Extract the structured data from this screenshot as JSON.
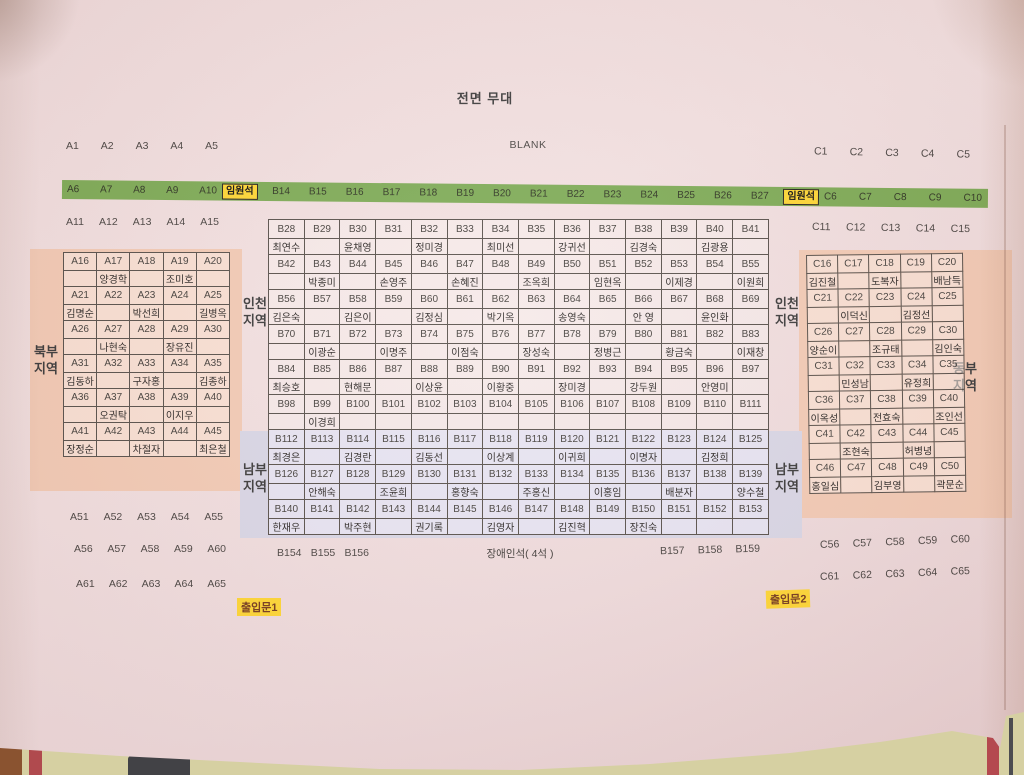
{
  "stage": {
    "title": "전면 무대",
    "blank": "BLANK"
  },
  "vip": "임원석",
  "doors": {
    "door1": "출입문1",
    "door2": "출입문2"
  },
  "disabled_seats": "장애인석( 4석 )",
  "regions": {
    "north": "북부지역",
    "incheon_left": "인천지역",
    "incheon_right": "인천지역",
    "south_left": "남부지역",
    "south_right": "남부지역",
    "east": "동부지역"
  },
  "green_row": {
    "left": [
      "A6",
      "A7",
      "A8",
      "A9",
      "A10"
    ],
    "center": [
      "B14",
      "B15",
      "B16",
      "B17",
      "B18",
      "B19",
      "B20",
      "B21",
      "B22",
      "B23",
      "B24",
      "B25",
      "B26",
      "B27"
    ],
    "right": [
      "C6",
      "C7",
      "C8",
      "C9",
      "C10"
    ]
  },
  "rows": {
    "a1": [
      "A1",
      "A2",
      "A3",
      "A4",
      "A5"
    ],
    "a11": [
      "A11",
      "A12",
      "A13",
      "A14",
      "A15"
    ],
    "a46": [
      "A46",
      "A47",
      "A48",
      "A49",
      "A50"
    ],
    "a51": [
      "A51",
      "A52",
      "A53",
      "A54",
      "A55"
    ],
    "a56": [
      "A56",
      "A57",
      "A58",
      "A59",
      "A60"
    ],
    "a61": [
      "A61",
      "A62",
      "A63",
      "A64",
      "A65"
    ],
    "c1": [
      "C1",
      "C2",
      "C3",
      "C4",
      "C5"
    ],
    "c11": [
      "C11",
      "C12",
      "C13",
      "C14",
      "C15"
    ],
    "c51": [
      "C51",
      "C52",
      "C53",
      "C54",
      "C55"
    ],
    "c56": [
      "C56",
      "C57",
      "C58",
      "C59",
      "C60"
    ],
    "c61": [
      "C61",
      "C62",
      "C63",
      "C64",
      "C65"
    ],
    "b154": [
      "B154",
      "B155",
      "B156"
    ],
    "b157": [
      "B157",
      "B158",
      "B159"
    ]
  },
  "tables": {
    "a": [
      {
        "seats": [
          "A16",
          "A17",
          "A18",
          "A19",
          "A20"
        ],
        "names": [
          "",
          "양경학",
          "",
          "조미호",
          ""
        ]
      },
      {
        "seats": [
          "A21",
          "A22",
          "A23",
          "A24",
          "A25"
        ],
        "names": [
          "김명순",
          "",
          "박선희",
          "",
          "길병옥"
        ]
      },
      {
        "seats": [
          "A26",
          "A27",
          "A28",
          "A29",
          "A30"
        ],
        "names": [
          "",
          "나현숙",
          "",
          "장유진",
          ""
        ]
      },
      {
        "seats": [
          "A31",
          "A32",
          "A33",
          "A34",
          "A35"
        ],
        "names": [
          "김동하",
          "",
          "구자홍",
          "",
          "김종하"
        ]
      },
      {
        "seats": [
          "A36",
          "A37",
          "A38",
          "A39",
          "A40"
        ],
        "names": [
          "",
          "오권탁",
          "",
          "이지우",
          ""
        ]
      },
      {
        "seats": [
          "A41",
          "A42",
          "A43",
          "A44",
          "A45"
        ],
        "names": [
          "장정순",
          "",
          "차절자",
          "",
          "최은철"
        ]
      }
    ],
    "b": [
      {
        "seats": [
          "B28",
          "B29",
          "B30",
          "B31",
          "B32",
          "B33",
          "B34",
          "B35",
          "B36",
          "B37",
          "B38",
          "B39",
          "B40",
          "B41"
        ],
        "names": [
          "최연수",
          "",
          "윤채영",
          "",
          "정미경",
          "",
          "최미선",
          "",
          "강귀선",
          "",
          "김경숙",
          "",
          "김광용",
          ""
        ]
      },
      {
        "seats": [
          "B42",
          "B43",
          "B44",
          "B45",
          "B46",
          "B47",
          "B48",
          "B49",
          "B50",
          "B51",
          "B52",
          "B53",
          "B54",
          "B55"
        ],
        "names": [
          "",
          "박종미",
          "",
          "손영주",
          "",
          "손혜진",
          "",
          "조옥희",
          "",
          "임현옥",
          "",
          "이제경",
          "",
          "이원희"
        ]
      },
      {
        "seats": [
          "B56",
          "B57",
          "B58",
          "B59",
          "B60",
          "B61",
          "B62",
          "B63",
          "B64",
          "B65",
          "B66",
          "B67",
          "B68",
          "B69"
        ],
        "names": [
          "김은숙",
          "",
          "김은이",
          "",
          "김정심",
          "",
          "박기옥",
          "",
          "송영숙",
          "",
          "안 영",
          "",
          "윤인화",
          ""
        ]
      },
      {
        "seats": [
          "B70",
          "B71",
          "B72",
          "B73",
          "B74",
          "B75",
          "B76",
          "B77",
          "B78",
          "B79",
          "B80",
          "B81",
          "B82",
          "B83"
        ],
        "names": [
          "",
          "이광순",
          "",
          "이명주",
          "",
          "이점숙",
          "",
          "장성숙",
          "",
          "정병근",
          "",
          "황금숙",
          "",
          "이재창"
        ]
      },
      {
        "seats": [
          "B84",
          "B85",
          "B86",
          "B87",
          "B88",
          "B89",
          "B90",
          "B91",
          "B92",
          "B93",
          "B94",
          "B95",
          "B96",
          "B97"
        ],
        "names": [
          "최승호",
          "",
          "현해문",
          "",
          "이상윤",
          "",
          "이황중",
          "",
          "장미경",
          "",
          "강두원",
          "",
          "안영미",
          ""
        ]
      },
      {
        "seats": [
          "B98",
          "B99",
          "B100",
          "B101",
          "B102",
          "B103",
          "B104",
          "B105",
          "B106",
          "B107",
          "B108",
          "B109",
          "B110",
          "B111"
        ],
        "names": [
          "",
          "이경희",
          "",
          "",
          "",
          "",
          "",
          "",
          "",
          "",
          "",
          "",
          "",
          ""
        ]
      },
      {
        "seats": [
          "B112",
          "B113",
          "B114",
          "B115",
          "B116",
          "B117",
          "B118",
          "B119",
          "B120",
          "B121",
          "B122",
          "B123",
          "B124",
          "B125"
        ],
        "names": [
          "최경은",
          "",
          "김경란",
          "",
          "김동선",
          "",
          "이상계",
          "",
          "이귀희",
          "",
          "이명자",
          "",
          "김정희",
          ""
        ]
      },
      {
        "seats": [
          "B126",
          "B127",
          "B128",
          "B129",
          "B130",
          "B131",
          "B132",
          "B133",
          "B134",
          "B135",
          "B136",
          "B137",
          "B138",
          "B139"
        ],
        "names": [
          "",
          "안해숙",
          "",
          "조윤희",
          "",
          "홍향숙",
          "",
          "주홍신",
          "",
          "이홍임",
          "",
          "배분자",
          "",
          "양수철"
        ]
      },
      {
        "seats": [
          "B140",
          "B141",
          "B142",
          "B143",
          "B144",
          "B145",
          "B146",
          "B147",
          "B148",
          "B149",
          "B150",
          "B151",
          "B152",
          "B153"
        ],
        "names": [
          "한재우",
          "",
          "박주현",
          "",
          "권기록",
          "",
          "김영자",
          "",
          "김진혁",
          "",
          "장진숙",
          "",
          "",
          ""
        ]
      }
    ],
    "c": [
      {
        "seats": [
          "C16",
          "C17",
          "C18",
          "C19",
          "C20"
        ],
        "names": [
          "김진철",
          "",
          "도복자",
          "",
          "배남득"
        ]
      },
      {
        "seats": [
          "C21",
          "C22",
          "C23",
          "C24",
          "C25"
        ],
        "names": [
          "",
          "이덕신",
          "",
          "김정선",
          ""
        ]
      },
      {
        "seats": [
          "C26",
          "C27",
          "C28",
          "C29",
          "C30"
        ],
        "names": [
          "양순이",
          "",
          "조규태",
          "",
          "김인숙"
        ]
      },
      {
        "seats": [
          "C31",
          "C32",
          "C33",
          "C34",
          "C35"
        ],
        "names": [
          "",
          "민성남",
          "",
          "유정희",
          ""
        ]
      },
      {
        "seats": [
          "C36",
          "C37",
          "C38",
          "C39",
          "C40"
        ],
        "names": [
          "이옥성",
          "",
          "전효숙",
          "",
          "조인선"
        ]
      },
      {
        "seats": [
          "C41",
          "C42",
          "C43",
          "C44",
          "C45"
        ],
        "names": [
          "",
          "조현숙",
          "",
          "허병녕",
          ""
        ]
      },
      {
        "seats": [
          "C46",
          "C47",
          "C48",
          "C49",
          "C50"
        ],
        "names": [
          "홍일심",
          "",
          "김부영",
          "",
          "곽문순"
        ]
      }
    ]
  }
}
